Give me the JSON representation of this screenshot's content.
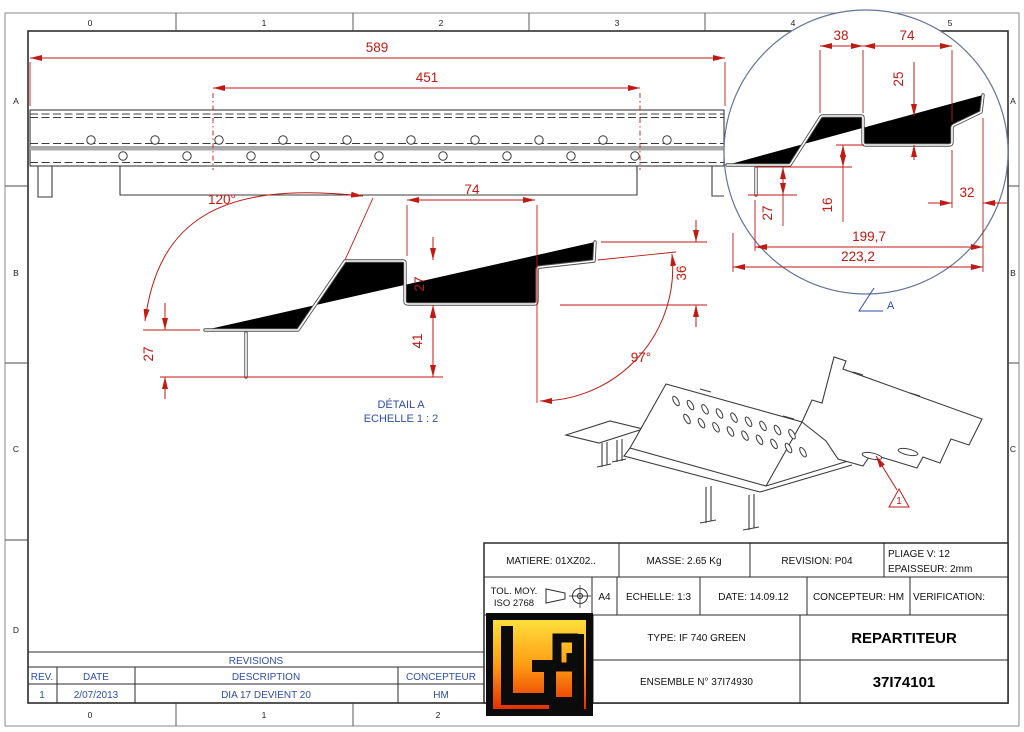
{
  "drawing": {
    "zones": {
      "top": [
        "0",
        "1",
        "2",
        "3",
        "4",
        "5"
      ],
      "bottom": [
        "0",
        "1",
        "2"
      ],
      "left": [
        "A",
        "B",
        "C",
        "D"
      ],
      "right": [
        "A",
        "B",
        "C"
      ]
    },
    "colors": {
      "dimension_red": "#bf1a14",
      "annotation_blue": "#2e4da8",
      "line_dark": "#3c3c3c",
      "sheet_gray": "#a9a9a9",
      "logo_top": "#ffdf3c",
      "logo_mid": "#ff9d14",
      "logo_bottom": "#e43000"
    }
  },
  "main_view": {
    "dim_overall": "589",
    "dim_inner": "451"
  },
  "section_view": {
    "angle_left": "120°",
    "dim_top_width": "74",
    "dim_channel_depth": "27",
    "dim_leg_drop": "41",
    "dim_flange_height": "27",
    "dim_lip_height": "36",
    "angle_right": "97°",
    "caption_line1": "DÉTAIL A",
    "caption_line2": "ECHELLE 1 : 2"
  },
  "detail_view": {
    "label": "A",
    "dim_seg1": "38",
    "dim_seg2": "74",
    "dim_step": "25",
    "dim_flange": "27",
    "dim_offset": "16",
    "dim_lip": "32",
    "dim_inner_width": "199,7",
    "dim_outer_width": "223,2"
  },
  "iso_view": {
    "revision_flag": "1"
  },
  "title_block": {
    "matiere": "MATIERE: 01XZ02..",
    "masse": "MASSE: 2.65 Kg",
    "revision": "REVISION: P04",
    "pliage": "PLIAGE V: 12",
    "epaisseur": "EPAISSEUR: 2mm",
    "tol_line1": "TOL. MOY.",
    "tol_line2": "ISO 2768",
    "format": "A4",
    "echelle": "ECHELLE: 1:3",
    "date": "DATE: 14.09.12",
    "concepteur": "CONCEPTEUR: HM",
    "verification": "VERIFICATION:",
    "type": "TYPE: IF 740 GREEN",
    "ensemble": "ENSEMBLE N° 37I74930",
    "part_name": "REPARTITEUR",
    "part_number": "37I74101"
  },
  "revisions_table": {
    "title": "REVISIONS",
    "headers": [
      "REV.",
      "DATE",
      "DESCRIPTION",
      "CONCEPTEUR"
    ],
    "rows": [
      [
        "1",
        "2/07/2013",
        "DIA 17 DEVIENT 20",
        "HM"
      ]
    ]
  }
}
